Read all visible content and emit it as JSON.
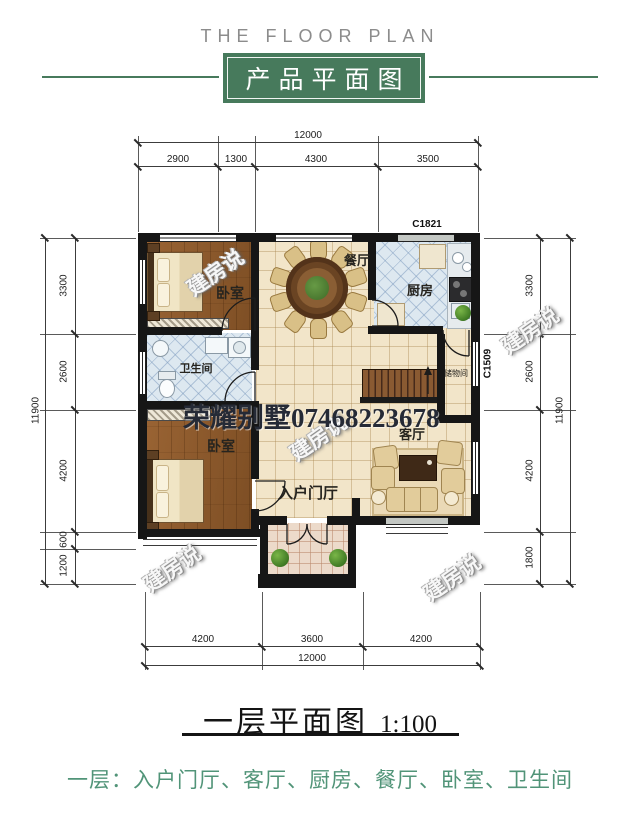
{
  "header": {
    "title_en": "THE FLOOR PLAN",
    "title_cn": "产品平面图"
  },
  "plan": {
    "window_codes": {
      "top": "C1821",
      "right": "C1509"
    },
    "rooms": {
      "bedroom1": "卧室",
      "bathroom": "卫生间",
      "bedroom2": "卧室",
      "dining": "餐厅",
      "kitchen": "厨房",
      "living": "客厅",
      "entry": "入户门厅",
      "storage": "储物间"
    },
    "dimensions": {
      "top": {
        "total": "12000",
        "segments": [
          "2900",
          "1300",
          "4300",
          "3500"
        ]
      },
      "bottom": {
        "total": "12000",
        "segments": [
          "4200",
          "3600",
          "4200"
        ]
      },
      "left": {
        "total": "11900",
        "segments": [
          "3300",
          "2600",
          "4200",
          "600",
          "1200"
        ]
      },
      "right": {
        "total": "11900",
        "segments": [
          "3300",
          "2600",
          "4200",
          "1800"
        ]
      }
    }
  },
  "watermark": {
    "brand": "建房说",
    "big": "荣耀别墅07468223678"
  },
  "footer": {
    "title": "一层平面图",
    "scale": "1:100",
    "rooms_line": "一层：入户门厅、客厅、厨房、餐厅、卧室、卫生间"
  },
  "colors": {
    "accent_green": "#477a5c",
    "footer_green": "#519478"
  }
}
